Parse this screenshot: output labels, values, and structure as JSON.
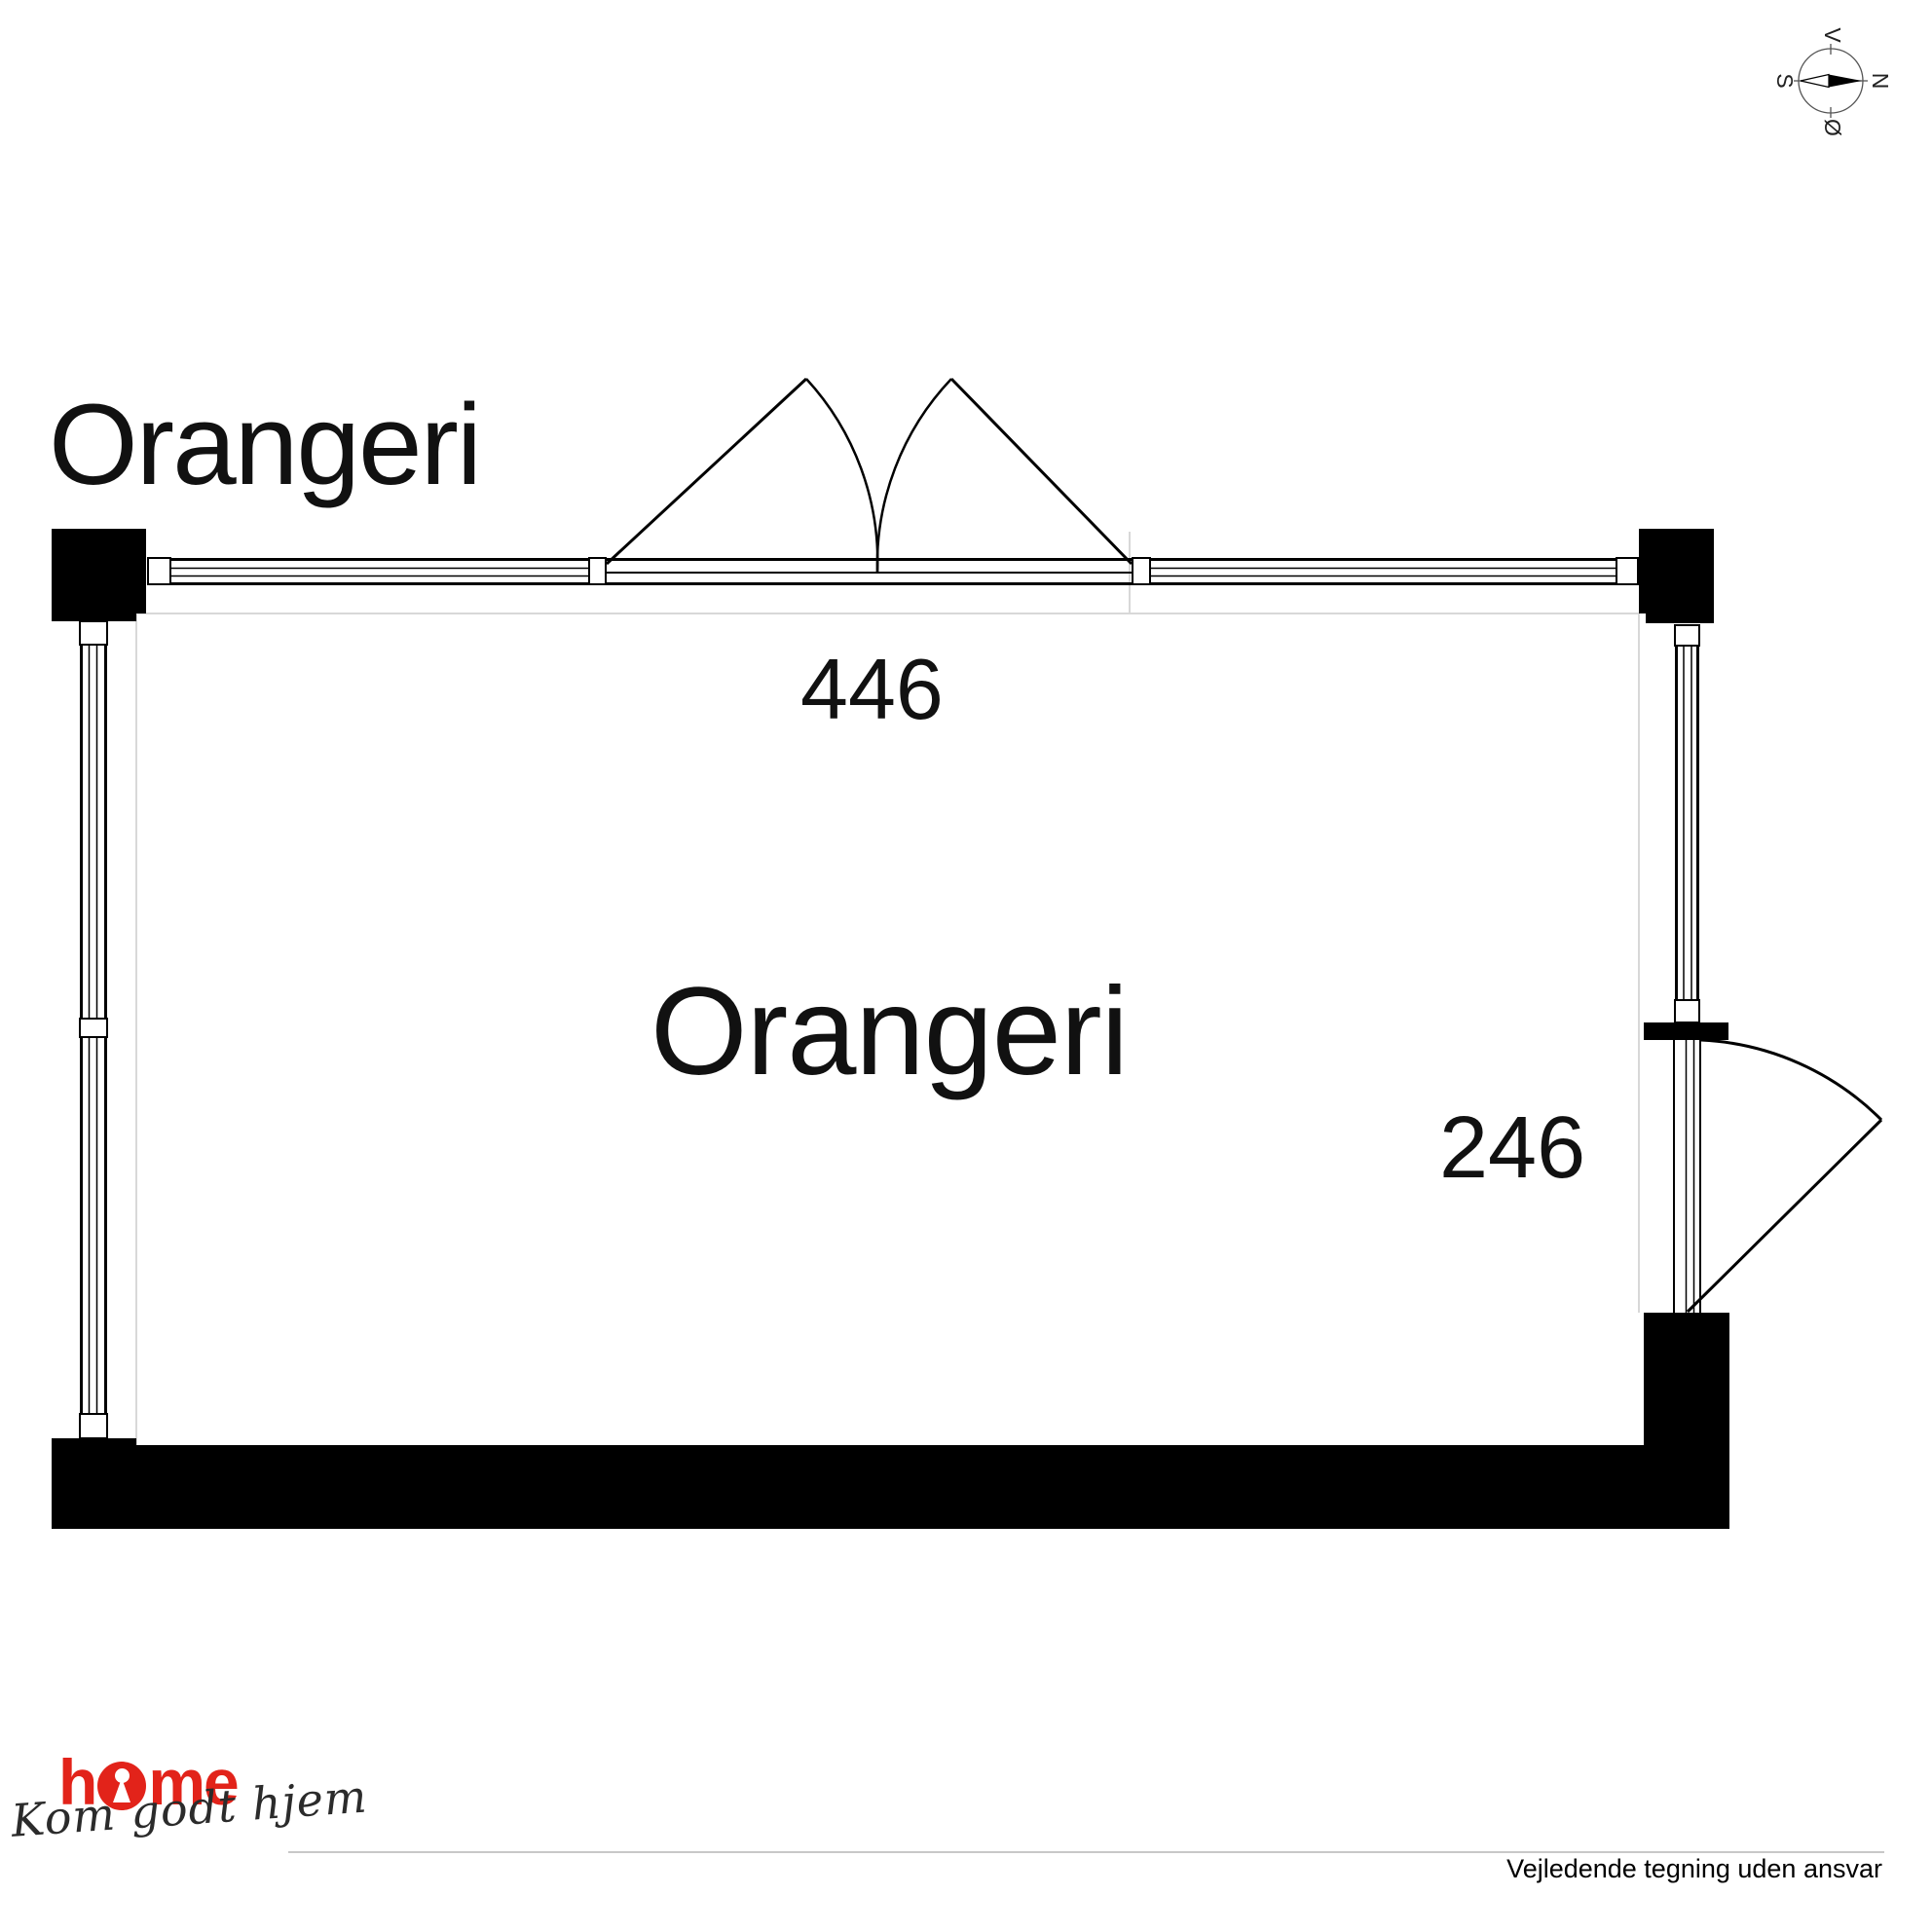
{
  "title": "Orangeri",
  "room": {
    "label": "Orangeri",
    "width_cm": "446",
    "depth_cm": "246"
  },
  "compass": {
    "top": "V",
    "right": "N",
    "left": "S",
    "bottom": "Ø"
  },
  "footer": {
    "logo_word": "home",
    "logo_h": "h",
    "logo_me": "me",
    "tagline": "Kom godt hjem",
    "disclaimer": "Vejledende tegning uden ansvar"
  },
  "colors": {
    "wall": "#000000",
    "logo_red": "#e2231a",
    "faint_line": "#d8d8d8"
  }
}
